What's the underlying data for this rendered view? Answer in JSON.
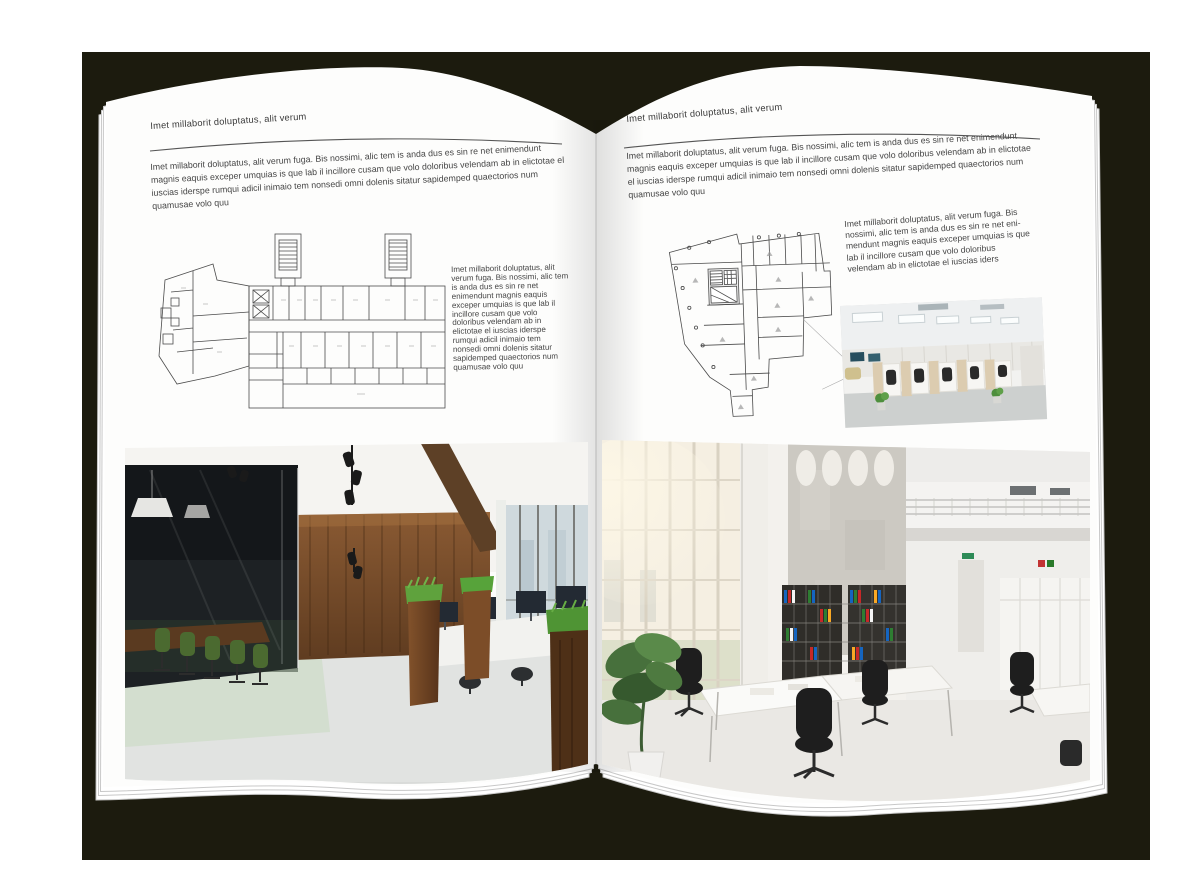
{
  "backdrop": {
    "page_background": "#ffffff",
    "cover_color": "#1c1b0e"
  },
  "left_page": {
    "header": "Imet millaborit doluptatus, alit verum",
    "intro": "Imet millaborit doluptatus, alit verum fuga. Bis nossimi, alic tem is anda dus es sin re net enimendunt magnis eaquis exceper umquias is que lab il incillore cusam que volo doloribus velendam ab in elictotae el iuscias iderspe rumqui adicil inimaio tem nonsedi omni dolenis sitatur sapidemped quaectorios num quamusae volo quu",
    "side_text": "Imet millaborit doluptatus, alit verum fuga. Bis nossimi, alic tem is anda dus es sin re net enimendunt magnis eaquis exceper umquias is que lab il incillore cusam que volo doloribus velendam ab in elictotae el iuscias iderspe rumqui adicil inimaio tem nonsedi omni dolenis sitatur sapidemped quaectorios num quamusae volo quu",
    "floor_plan": "architectural-floor-plan-line-drawing",
    "photo": "office-interior-wood-wall-glass-meeting-room"
  },
  "right_page": {
    "header": "Imet millaborit doluptatus, alit verum",
    "intro": "Imet millaborit doluptatus, alit verum fuga. Bis nossimi, alic tem is anda dus es sin re net enimendunt magnis eaquis exceper umquias is que lab il incillore cusam que volo doloribus velendam ab in elictotae el iuscias iderspe rumqui adicil inimaio tem nonsedi omni dolenis sitatur sapidemped quaectorios num quamusae volo quu",
    "side_text": "Imet millaborit doluptatus, alit verum fuga. Bis nossimi, alic tem is anda dus es sin re net eni-mendunt magnis eaquis exceper umquias is que lab il incillore cusam que volo doloribus velendam ab in elictotae el iuscias iders",
    "floor_plan": "architectural-floor-plan-line-drawing",
    "photo_small": "open-office-workstations",
    "photo_large": "bright-double-height-office-atrium"
  }
}
